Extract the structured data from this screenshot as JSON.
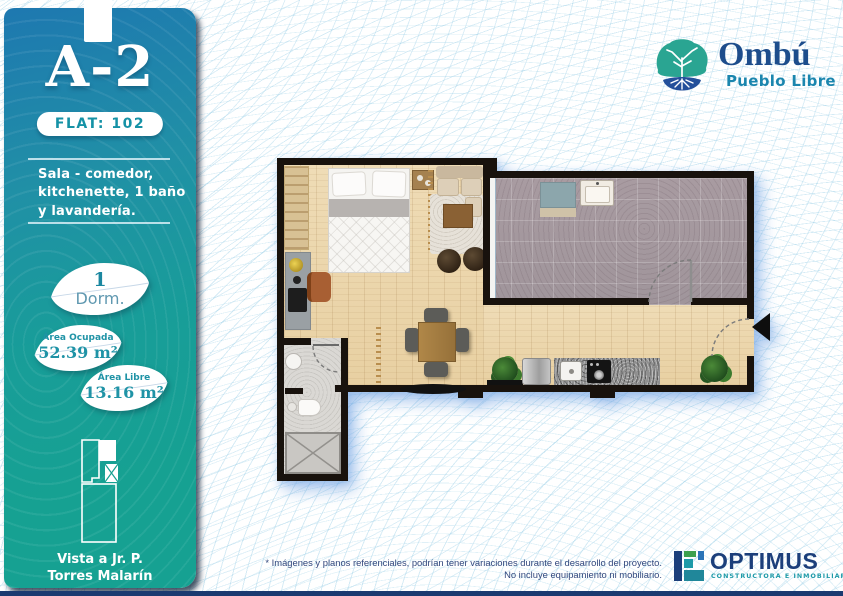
{
  "colors": {
    "sidebar_top": "#1e78b0",
    "sidebar_bottom": "#16a192",
    "accent_teal": "#1a90a5",
    "brand_blue": "#1d4d8c",
    "brand_teal": "#2aa592",
    "footer_navy": "#1b3a70",
    "optimus_blue": "#1c3f7b",
    "optimus_teal": "#1e9aa8"
  },
  "sidebar": {
    "unit_code": "A-2",
    "flat_label": "FLAT: 102",
    "description_lines": [
      "Sala - comedor,",
      "kitchenette, 1 baño",
      "y lavandería."
    ],
    "badges": [
      {
        "top": "1",
        "bottom": "Dorm."
      },
      {
        "top": "Área Ocupada",
        "bottom": "52.39 m²"
      },
      {
        "top": "Área Libre",
        "bottom": "13.16 m²"
      }
    ],
    "view_lines": [
      "Vista a Jr. P.",
      "Torres Malarín"
    ]
  },
  "brand": {
    "name": "Ombú",
    "district": "Pueblo Libre"
  },
  "footer": {
    "disclaimer_lines": [
      "* Imágenes y planos referenciales, podrían tener variaciones durante el desarrollo del proyecto.",
      "No incluye equipamiento ni mobiliario."
    ],
    "developer_name": "OPTIMUS",
    "developer_tagline": "CONSTRUCTORA E INMOBILIARIA"
  }
}
